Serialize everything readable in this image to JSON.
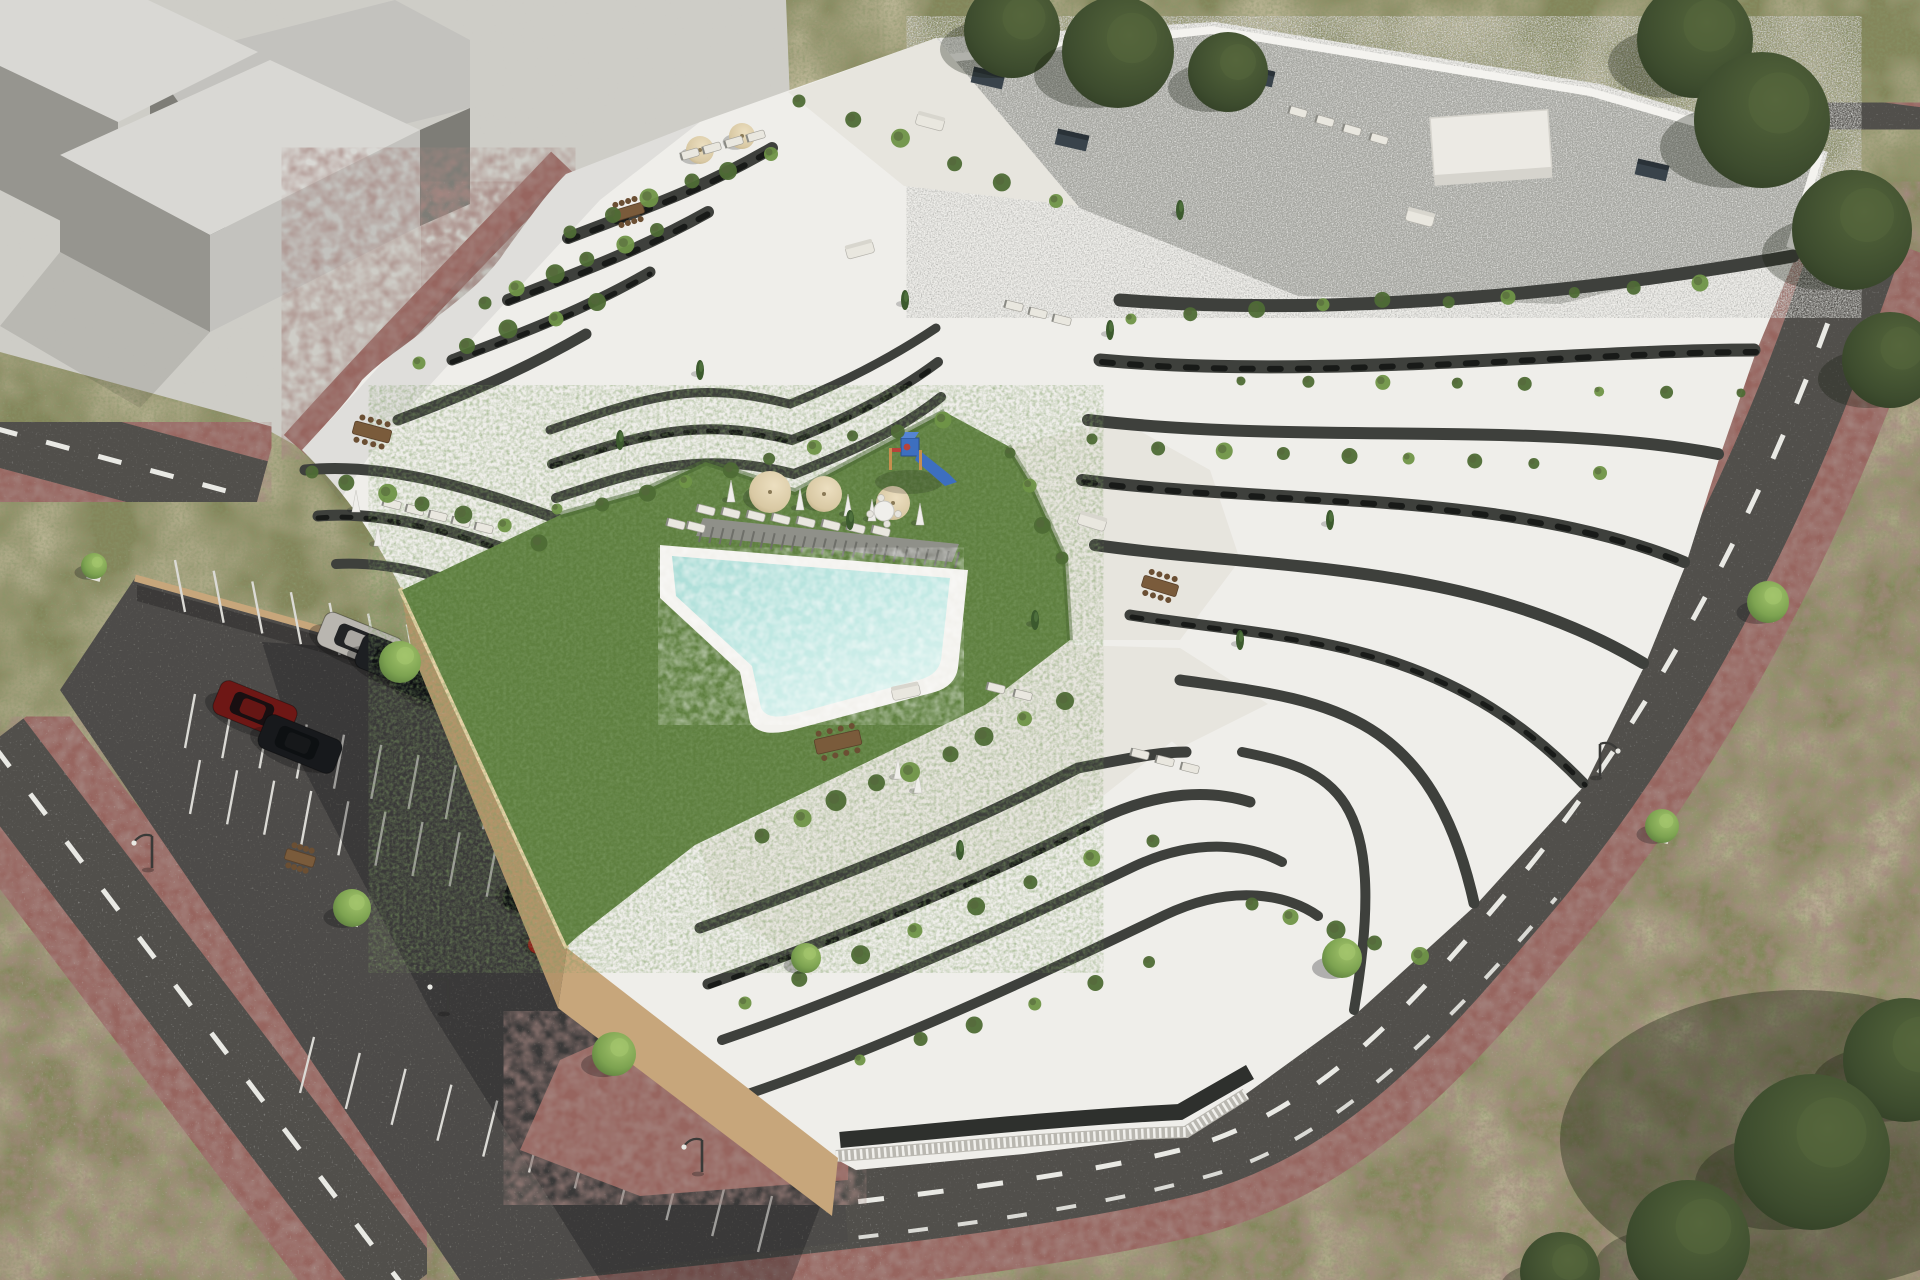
{
  "meta": {
    "aria_label": "Aerial 3D architectural rendering of a modern white terraced apartment complex with a green courtyard, freeform swimming pool, sun loungers and parasols, a small playground, a parking lot with cars, surrounding streets with red paver sidewalks, street trees and a pale abstract neighboring building massing in the upper left"
  },
  "palette": {
    "rough_base": "#84855a",
    "rough_tan": "#a8996b",
    "rough_dark": "#4c5c32",
    "concrete": "#cecdc7",
    "mass_top": "#d9d8d4",
    "mass_mid": "#c3c2be",
    "mass_dark": "#96958f",
    "mass_darkest": "#7e7d77",
    "road": "#514f4b",
    "road_dash": "#e9e9e4",
    "paver": "#97655f",
    "curb_tan": "#cfb189",
    "parking_asphalt": "#4e4c48",
    "stall_line": "#dbdad5",
    "wall_tan": "#c7a67b",
    "wall_tan_light": "#e8d3a8",
    "wood_wall": "#b3946a",
    "lawn": "#5f8040",
    "lawn_dark": "#46632f",
    "pool_water_edge": "#a9dcd6",
    "pool_water_light": "#d9f2ee",
    "pool_rim": "#f3f2ee",
    "deck": "#8f9089",
    "deck_gap": "#6e6f69",
    "building_white": "#efeeea",
    "building_shade": "#dddbd4",
    "tile": "#e7e5de",
    "dark_wall": "#3e403c",
    "dark_window": "#181a18",
    "gravel": "#a2a39d",
    "parapet": "#f4f3ef",
    "vent": "#39434b",
    "plant_green": "#4e6c35",
    "plant_green_light": "#6f9447",
    "tree_light": "#7da351",
    "tree_light_hi": "#a3c46c",
    "tree_dark": "#3d4c2e",
    "tree_dark_hi": "#55663c",
    "trunk": "#5d5148",
    "car_glass": "#0d0f11",
    "shadow": "rgba(15,16,18,0.30)",
    "umbrella_tan": "#d9c9a4",
    "umbrella_white": "#efeeea",
    "furniture_wood": "#7a5b3b",
    "sofa_light": "#e9e7df",
    "sofa_dark": "#3a4450",
    "balustrade": "#f1f0ec",
    "play_blue": "#3d6fc0",
    "play_red": "#b8433a",
    "play_wood": "#c78f4e",
    "lamp": "#3a3a38"
  },
  "objects": {
    "cars": [
      {
        "name": "silver-sedan",
        "x": 360,
        "y": 642,
        "len": 84,
        "wid": 36,
        "color": "#b9b6b0"
      },
      {
        "name": "black-sedan-1",
        "x": 398,
        "y": 664,
        "len": 84,
        "wid": 36,
        "color": "#1d1f22"
      },
      {
        "name": "black-sedan-2",
        "x": 436,
        "y": 686,
        "len": 84,
        "wid": 36,
        "color": "#141619"
      },
      {
        "name": "dark-red-sedan",
        "x": 255,
        "y": 710,
        "len": 82,
        "wid": 36,
        "color": "#6e1715"
      },
      {
        "name": "black-sedan-3",
        "x": 300,
        "y": 744,
        "len": 82,
        "wid": 36,
        "color": "#17191c"
      },
      {
        "name": "sage-green-suv",
        "x": 540,
        "y": 763,
        "len": 80,
        "wid": 40,
        "color": "#75857a"
      },
      {
        "name": "dark-grey-sedan",
        "x": 588,
        "y": 801,
        "len": 82,
        "wid": 36,
        "color": "#3f3f47"
      },
      {
        "name": "black-sedan-4",
        "x": 545,
        "y": 903,
        "len": 82,
        "wid": 36,
        "color": "#101214"
      },
      {
        "name": "red-hatchback",
        "x": 567,
        "y": 947,
        "len": 76,
        "wid": 36,
        "color": "#8c1d18"
      }
    ],
    "street_trees": [
      {
        "x": 400,
        "y": 662,
        "r": 21
      },
      {
        "x": 352,
        "y": 908,
        "r": 19
      },
      {
        "x": 614,
        "y": 1054,
        "r": 22
      },
      {
        "x": 806,
        "y": 958,
        "r": 15
      },
      {
        "x": 1342,
        "y": 958,
        "r": 20
      },
      {
        "x": 1768,
        "y": 602,
        "r": 21
      },
      {
        "x": 1662,
        "y": 826,
        "r": 17
      },
      {
        "x": 94,
        "y": 566,
        "r": 13
      }
    ],
    "dark_trees": [
      {
        "x": 1012,
        "y": 30,
        "r": 48
      },
      {
        "x": 1118,
        "y": 52,
        "r": 56
      },
      {
        "x": 1228,
        "y": 72,
        "r": 40
      },
      {
        "x": 1695,
        "y": 40,
        "r": 58
      },
      {
        "x": 1762,
        "y": 120,
        "r": 68
      },
      {
        "x": 1852,
        "y": 230,
        "r": 60
      },
      {
        "x": 1890,
        "y": 360,
        "r": 48
      },
      {
        "x": 1905,
        "y": 1060,
        "r": 62
      },
      {
        "x": 1812,
        "y": 1152,
        "r": 78
      },
      {
        "x": 1688,
        "y": 1242,
        "r": 62
      },
      {
        "x": 1560,
        "y": 1272,
        "r": 40
      }
    ],
    "lamps": [
      {
        "x": 152,
        "y": 868,
        "dir": -1
      },
      {
        "x": 448,
        "y": 1012,
        "dir": -1
      },
      {
        "x": 702,
        "y": 1172,
        "dir": -1
      },
      {
        "x": 1600,
        "y": 776,
        "dir": 1
      }
    ],
    "umbrellas_tan": [
      {
        "x": 770,
        "y": 492,
        "r": 21
      },
      {
        "x": 824,
        "y": 494,
        "r": 18
      },
      {
        "x": 893,
        "y": 503,
        "r": 17
      },
      {
        "x": 700,
        "y": 150,
        "r": 14
      },
      {
        "x": 742,
        "y": 136,
        "r": 13
      }
    ],
    "umbrellas_folded": [
      {
        "x": 731,
        "y": 496
      },
      {
        "x": 800,
        "y": 504
      },
      {
        "x": 848,
        "y": 510
      },
      {
        "x": 872,
        "y": 515
      },
      {
        "x": 920,
        "y": 519
      },
      {
        "x": 356,
        "y": 506
      },
      {
        "x": 378,
        "y": 540
      },
      {
        "x": 898,
        "y": 773
      },
      {
        "x": 918,
        "y": 787
      }
    ],
    "round_table": {
      "x": 884,
      "y": 511,
      "r": 10
    },
    "lounger_rows": [
      {
        "x": 706,
        "y": 510,
        "n": 8,
        "dx": 25,
        "dy": 3,
        "ang": 14
      },
      {
        "x": 676,
        "y": 524,
        "n": 2,
        "dx": 20,
        "dy": 3,
        "ang": 14
      },
      {
        "x": 392,
        "y": 504,
        "n": 5,
        "dx": 23,
        "dy": 6,
        "ang": 14
      },
      {
        "x": 690,
        "y": 154,
        "n": 4,
        "dx": 22,
        "dy": -6,
        "ang": -16
      },
      {
        "x": 1298,
        "y": 112,
        "n": 4,
        "dx": 27,
        "dy": 9,
        "ang": 16
      },
      {
        "x": 996,
        "y": 688,
        "n": 2,
        "dx": 27,
        "dy": 7,
        "ang": 14
      },
      {
        "x": 1140,
        "y": 754,
        "n": 3,
        "dx": 25,
        "dy": 7,
        "ang": 14
      },
      {
        "x": 1014,
        "y": 306,
        "n": 3,
        "dx": 24,
        "dy": 7,
        "ang": 14
      }
    ],
    "dining_tables": [
      {
        "x": 838,
        "y": 742,
        "w": 46,
        "h": 15,
        "ang": -13
      },
      {
        "x": 372,
        "y": 432,
        "w": 38,
        "h": 13,
        "ang": 15
      },
      {
        "x": 628,
        "y": 212,
        "w": 32,
        "h": 11,
        "ang": -17
      },
      {
        "x": 1160,
        "y": 586,
        "w": 36,
        "h": 12,
        "ang": 17
      },
      {
        "x": 300,
        "y": 858,
        "w": 30,
        "h": 11,
        "ang": 17
      }
    ],
    "sofas": [
      {
        "x": 930,
        "y": 122,
        "ang": 15
      },
      {
        "x": 1092,
        "y": 522,
        "ang": 17
      },
      {
        "x": 906,
        "y": 692,
        "ang": -12
      },
      {
        "x": 860,
        "y": 250,
        "ang": -15
      },
      {
        "x": 1420,
        "y": 218,
        "ang": 15
      }
    ],
    "roof_vents": [
      {
        "x": 1130,
        "y": 48
      },
      {
        "x": 1258,
        "y": 76
      },
      {
        "x": 1452,
        "y": 128
      },
      {
        "x": 1652,
        "y": 170
      },
      {
        "x": 1072,
        "y": 140
      },
      {
        "x": 988,
        "y": 78
      }
    ],
    "penthouse_box": {
      "x": 1430,
      "y": 118,
      "w": 118,
      "h": 58,
      "ang": -4
    },
    "plant_rows": [
      {
        "x1": 560,
        "y1": 512,
        "x2": 940,
        "y2": 418,
        "n": 10,
        "r": 7
      },
      {
        "x1": 570,
        "y1": 232,
        "x2": 770,
        "y2": 152,
        "n": 6,
        "r": 8
      },
      {
        "x1": 482,
        "y1": 300,
        "x2": 660,
        "y2": 232,
        "n": 6,
        "r": 8
      },
      {
        "x1": 420,
        "y1": 364,
        "x2": 600,
        "y2": 300,
        "n": 5,
        "r": 8
      },
      {
        "x1": 310,
        "y1": 470,
        "x2": 540,
        "y2": 540,
        "n": 7,
        "r": 8
      },
      {
        "x1": 1012,
        "y1": 455,
        "x2": 1062,
        "y2": 556,
        "n": 4,
        "r": 7
      },
      {
        "x1": 1130,
        "y1": 318,
        "x2": 1700,
        "y2": 284,
        "n": 10,
        "r": 7
      },
      {
        "x1": 1095,
        "y1": 442,
        "x2": 1600,
        "y2": 470,
        "n": 9,
        "r": 7
      },
      {
        "x1": 762,
        "y1": 836,
        "x2": 1062,
        "y2": 702,
        "n": 9,
        "r": 9
      },
      {
        "x1": 742,
        "y1": 1000,
        "x2": 1150,
        "y2": 838,
        "n": 8,
        "r": 8
      },
      {
        "x1": 800,
        "y1": 102,
        "x2": 1056,
        "y2": 200,
        "n": 6,
        "r": 8
      },
      {
        "x1": 1250,
        "y1": 902,
        "x2": 1420,
        "y2": 958,
        "n": 5,
        "r": 8
      },
      {
        "x1": 862,
        "y1": 1062,
        "x2": 1150,
        "y2": 962,
        "n": 6,
        "r": 7
      },
      {
        "x1": 1240,
        "y1": 380,
        "x2": 1740,
        "y2": 392,
        "n": 8,
        "r": 6
      }
    ],
    "cypresses": [
      {
        "x": 905,
        "y": 300
      },
      {
        "x": 1110,
        "y": 330
      },
      {
        "x": 850,
        "y": 520
      },
      {
        "x": 1035,
        "y": 620
      },
      {
        "x": 960,
        "y": 850
      },
      {
        "x": 1240,
        "y": 640
      },
      {
        "x": 700,
        "y": 370
      },
      {
        "x": 620,
        "y": 440
      },
      {
        "x": 1180,
        "y": 210
      },
      {
        "x": 1330,
        "y": 520
      }
    ],
    "stall_rows": [
      {
        "x1": 185,
        "y1": 612,
        "x2": 610,
        "y2": 730,
        "n": 12,
        "vx": -10,
        "vy": -52
      },
      {
        "x1": 185,
        "y1": 748,
        "x2": 632,
        "y2": 870,
        "n": 13,
        "vx": 10,
        "vy": -54
      },
      {
        "x1": 200,
        "y1": 760,
        "x2": 645,
        "y2": 884,
        "n": 13,
        "vx": -10,
        "vy": 54
      },
      {
        "x1": 300,
        "y1": 1093,
        "x2": 758,
        "y2": 1252,
        "n": 11,
        "vx": 14,
        "vy": -56
      }
    ],
    "deck": {
      "x1": 703,
      "y1": 526,
      "x2": 959,
      "y2": 552,
      "n": 26,
      "vx": -4,
      "vy": 16
    },
    "playground": {
      "x": 905,
      "y": 452
    }
  }
}
